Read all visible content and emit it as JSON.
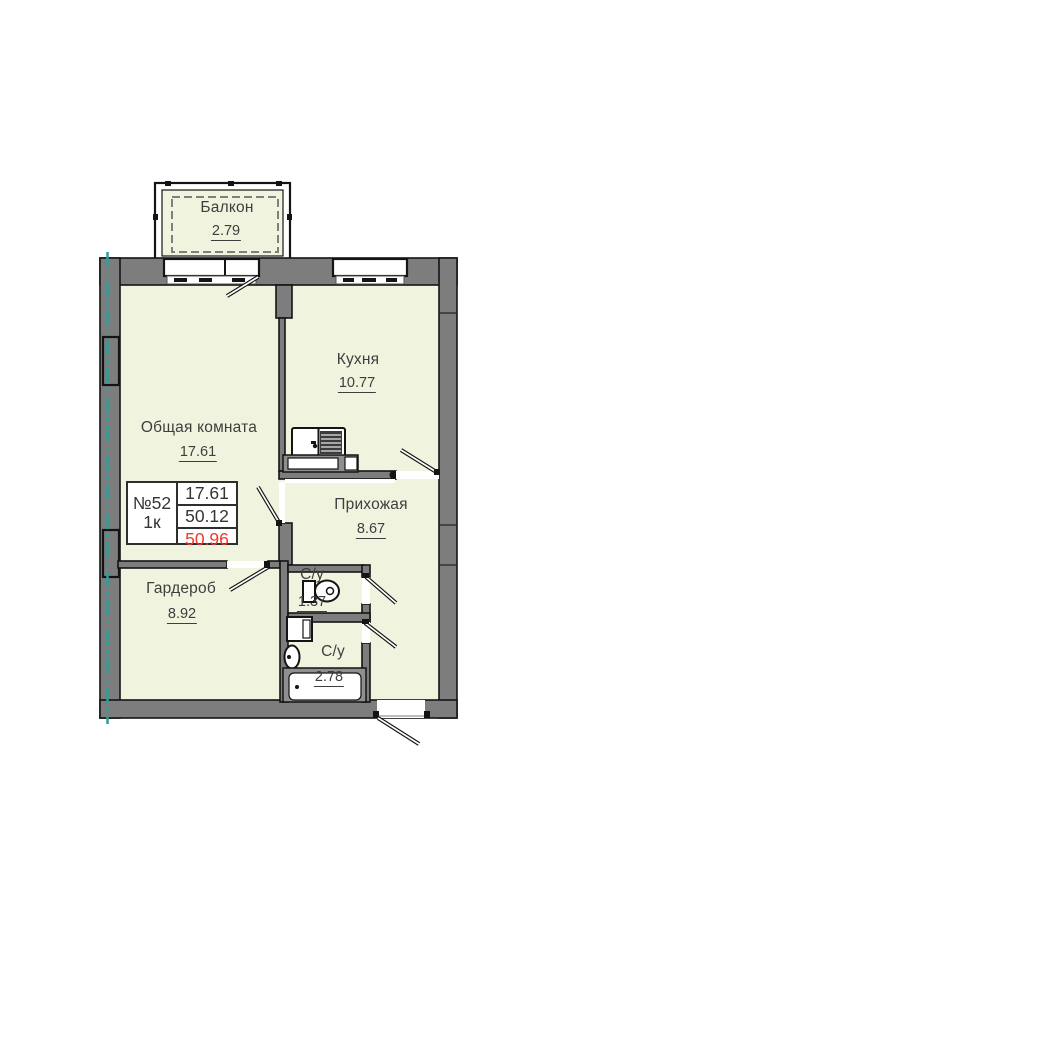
{
  "unit_card": {
    "number": "№52",
    "rooms": "1к",
    "area_living": "17.61",
    "area_without_balcony": "50.12",
    "area_total": "50.96"
  },
  "rooms": {
    "balcony": {
      "name": "Балкон",
      "area": "2.79"
    },
    "kitchen": {
      "name": "Кухня",
      "area": "10.77"
    },
    "living_room": {
      "name": "Общая комната",
      "area": "17.61"
    },
    "hallway": {
      "name": "Прихожая",
      "area": "8.67"
    },
    "wardrobe": {
      "name": "Гардероб",
      "area": "8.92"
    },
    "wc_small": {
      "name": "С/у",
      "area": "1.37"
    },
    "bathroom": {
      "name": "С/у",
      "area": "2.78"
    }
  },
  "colors": {
    "room_fill": "#f0f4de",
    "wall_gray": "#7d7d7d",
    "outline": "#141414",
    "axis_teal": "#2f9e99",
    "label_text": "#3e3e3e",
    "total_area_red": "#ee3a2c"
  }
}
